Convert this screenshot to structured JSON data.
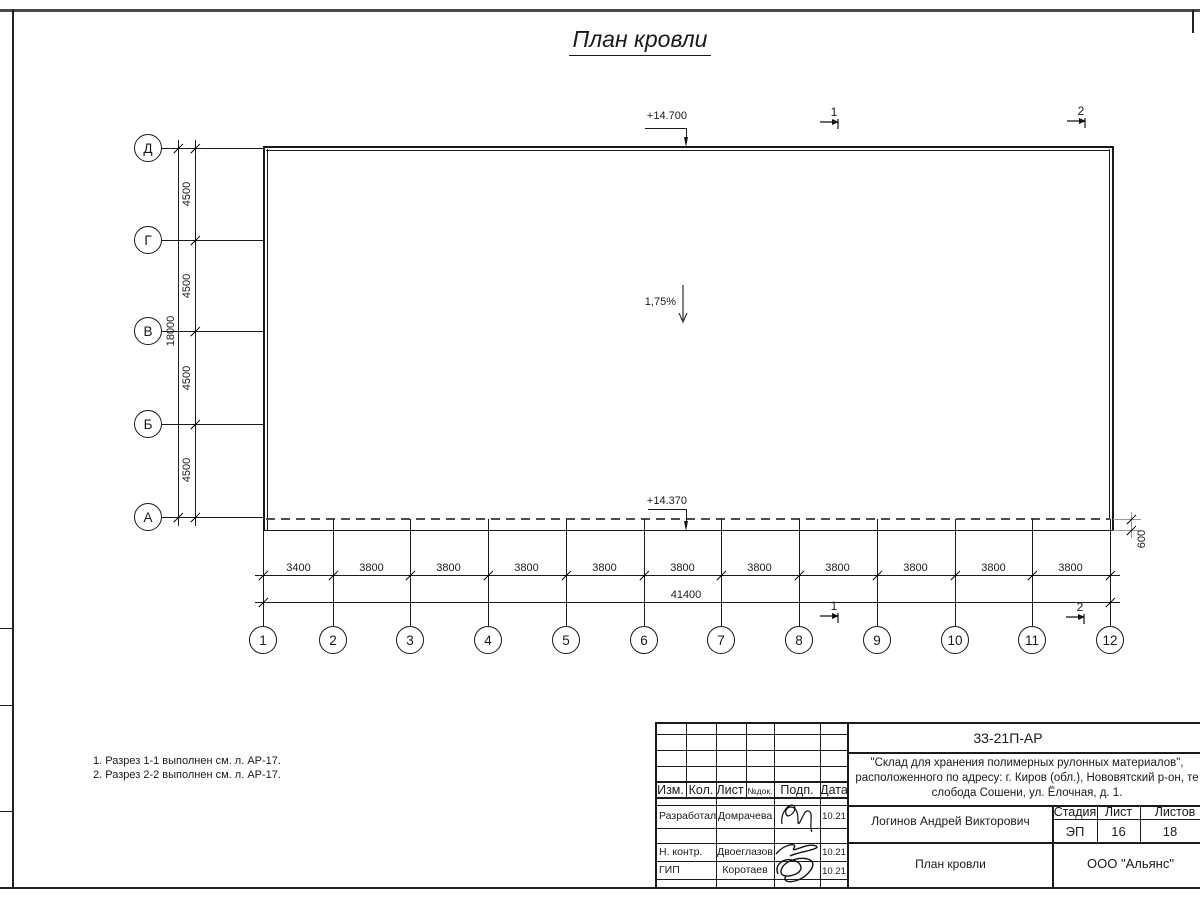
{
  "title": "План кровли",
  "plan": {
    "elevation_top": "+14.700",
    "elevation_bottom": "+14.370",
    "slope": "1,75%",
    "overhang_dim": "600",
    "left_axes": [
      "Д",
      "Г",
      "В",
      "Б",
      "А"
    ],
    "left_dims": [
      "4500",
      "4500",
      "4500",
      "4500"
    ],
    "left_total": "18000",
    "bottom_axes": [
      "1",
      "2",
      "3",
      "4",
      "5",
      "6",
      "7",
      "8",
      "9",
      "10",
      "11",
      "12"
    ],
    "bottom_dims": [
      "3400",
      "3800",
      "3800",
      "3800",
      "3800",
      "3800",
      "3800",
      "3800",
      "3800",
      "3800",
      "3800"
    ],
    "bottom_total": "41400",
    "section_1": "1",
    "section_2": "2"
  },
  "notes": {
    "line1": "1. Разрез 1-1 выполнен см. л. АР-17.",
    "line2": "2. Разрез 2-2 выполнен см. л. АР-17."
  },
  "titleblock": {
    "doc_code": "33-21П-АР",
    "project_line1": "\"Склад для хранения полимерных рулонных материалов\",",
    "project_line2": "расположенного по адресу: г. Киров (обл.), Нововятский р-он, те",
    "project_line3": "слобода Сошени, ул. Ёлочная, д. 1.",
    "rev_headers": [
      "Изм.",
      "Кол.",
      "Лист",
      "№док.",
      "Подп.",
      "Дата"
    ],
    "roles": [
      {
        "role": "Разработал",
        "name": "Домрачева",
        "date": "10.21"
      },
      {
        "role": "Н. контр.",
        "name": "Двоеглазов",
        "date": "10.21"
      },
      {
        "role": "ГИП",
        "name": "Коротаев",
        "date": "10.21"
      }
    ],
    "chief": "Логинов Андрей Викторович",
    "stage_label": "Стадия",
    "sheet_label": "Лист",
    "sheets_label": "Листов",
    "stage": "ЭП",
    "sheet": "16",
    "sheets": "18",
    "drawing_name": "План кровли",
    "company": "ООО \"Альянс\""
  }
}
